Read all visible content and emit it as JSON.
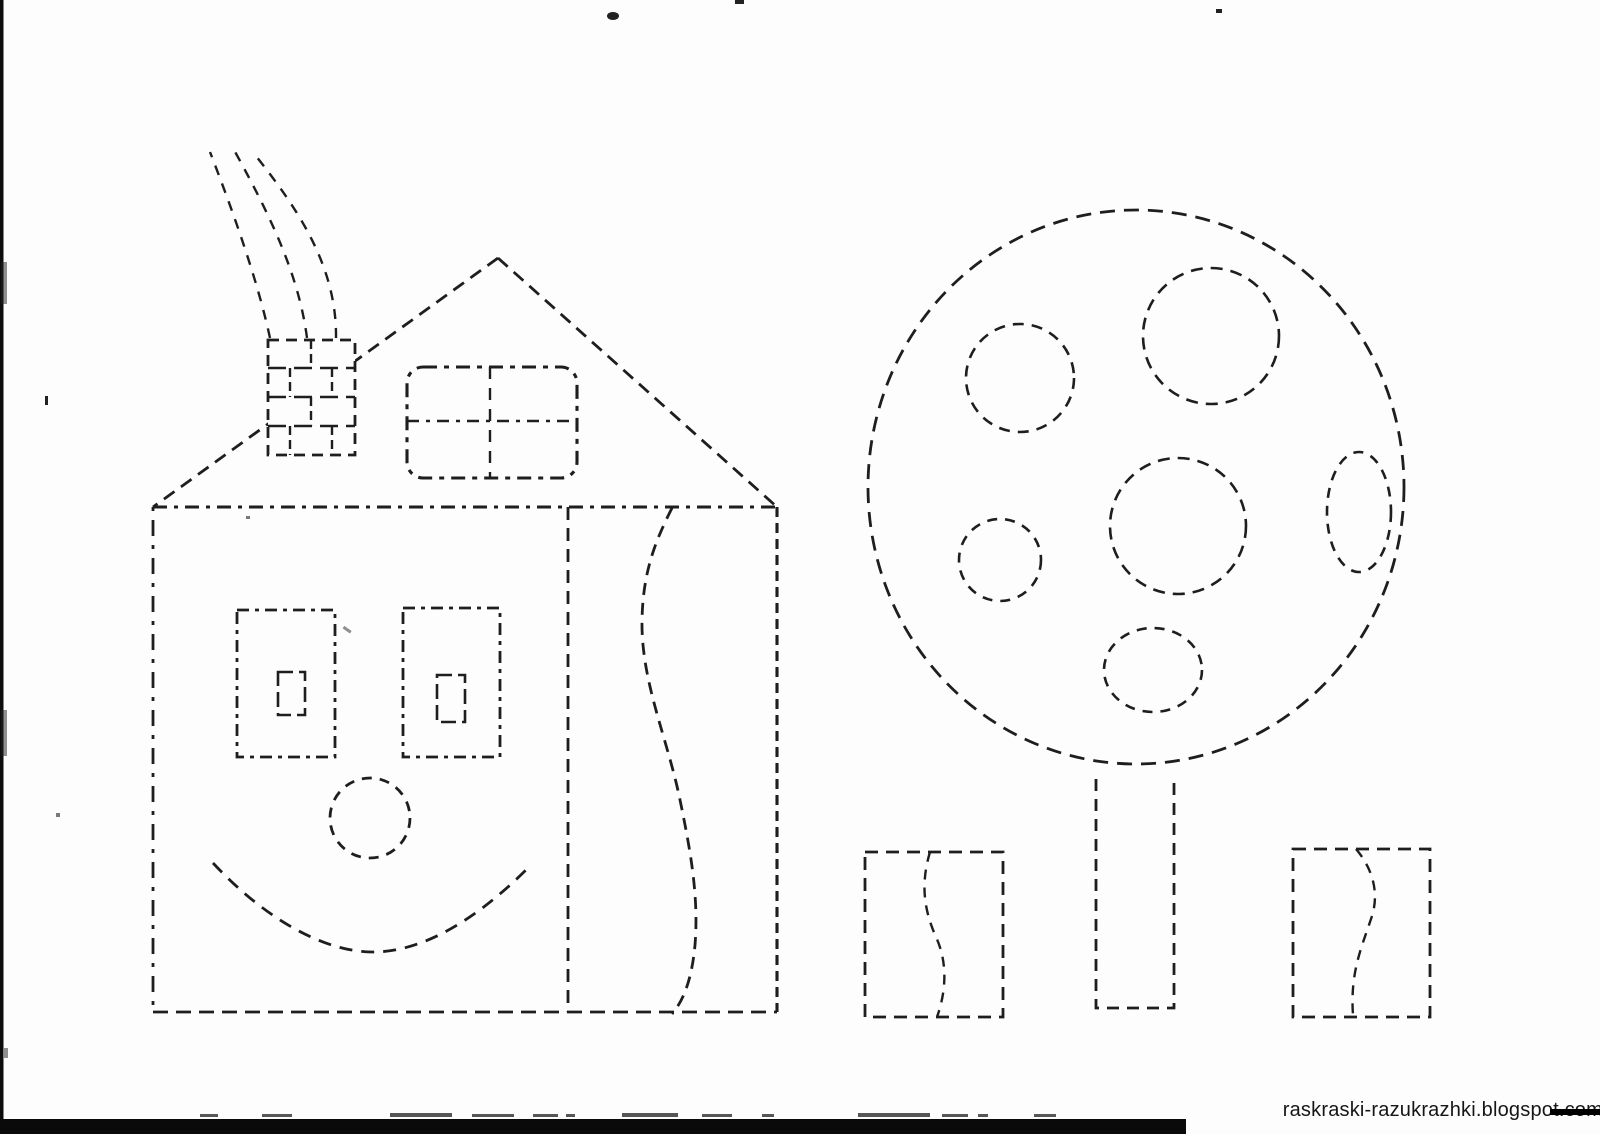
{
  "watermark": {
    "text": "raskraski-razukrazhki.blogspot.com"
  },
  "colors": {
    "background": "#fdfdfd",
    "line": "#1e1e1e",
    "scan_bar": "#0a0a0a",
    "watermark_text": "#161616"
  },
  "scene": {
    "type": "dashed-outline tracing coloring page",
    "elements": [
      {
        "name": "house",
        "parts": [
          "roof",
          "chimney-with-bricks",
          "smoke-curls",
          "attic-window-four-panes",
          "left-window-with-vent",
          "right-window-with-vent",
          "round-nose-circle",
          "smile-curve",
          "door-divider",
          "door-wavy-curve"
        ]
      },
      {
        "name": "tree",
        "parts": [
          "round-crown",
          "six-apple-circles",
          "rectangular-trunk"
        ]
      },
      {
        "name": "bush-left",
        "parts": [
          "rectangle",
          "wavy-line"
        ]
      },
      {
        "name": "bush-right",
        "parts": [
          "rectangle",
          "wavy-line"
        ]
      }
    ]
  },
  "artifacts": {
    "left_edge_bar": "black vertical scan line",
    "bottom_bar": "black horizontal scan bar",
    "strikethrough": "black line over end of watermark"
  }
}
